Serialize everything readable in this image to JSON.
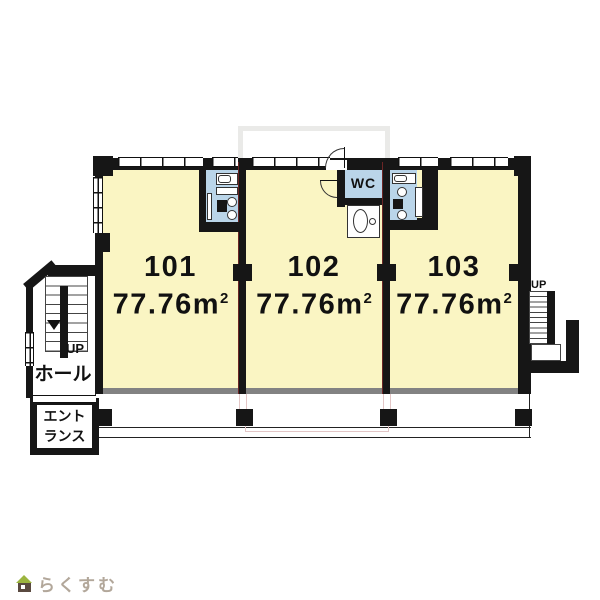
{
  "plan": {
    "rooms": [
      {
        "number": "101",
        "area_value": "77.76",
        "area_unit": "m",
        "area_exponent": "2"
      },
      {
        "number": "102",
        "area_value": "77.76",
        "area_unit": "m",
        "area_exponent": "2"
      },
      {
        "number": "103",
        "area_value": "77.76",
        "area_unit": "m",
        "area_exponent": "2"
      }
    ],
    "wc_label": "WC",
    "left_stair_up_label": "UP",
    "right_stair_up_label": "UP",
    "hall_label": "ホール",
    "entrance_label_line1": "エント",
    "entrance_label_line2": "ランス"
  },
  "watermark": {
    "logo_text": "らくすむ",
    "icon": "house-icon"
  },
  "colors": {
    "room_fill": "#FAF5C3",
    "wet_fill": "#BAD5E9",
    "wall": "#161616",
    "balcony_gray": "#828282",
    "accent_pink": "#E3C6C6",
    "logo_text": "#B2A79A",
    "logo_roof": "#9CB53F",
    "logo_body": "#5A4A40"
  }
}
